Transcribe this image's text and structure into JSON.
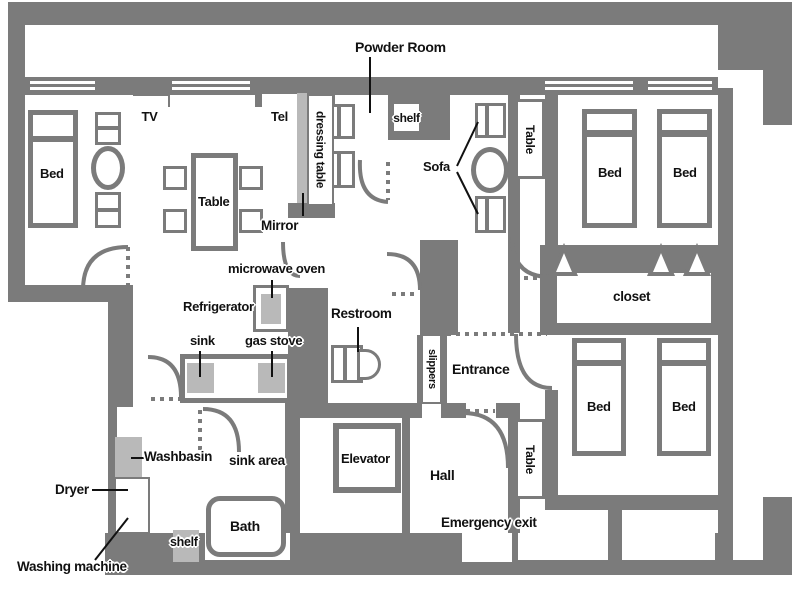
{
  "title": "Apartment floor plan",
  "colors": {
    "wall": "#7b7b7b",
    "fixture": "#b9b9b9",
    "text": "#111111",
    "background": "#ffffff"
  },
  "labels": {
    "powder_room": "Powder Room",
    "tv": "TV",
    "tel": "Tel",
    "dressing_table": "dressing table",
    "mirror": "Mirror",
    "shelf_top": "shelf",
    "sofa": "Sofa",
    "table_top_right": "Table",
    "bed_left": "Bed",
    "dining_table": "Table",
    "bed_top_1": "Bed",
    "bed_top_2": "Bed",
    "closet": "closet",
    "microwave_oven": "microwave oven",
    "refrigerator": "Refrigerator",
    "sink": "sink",
    "gas_stove": "gas stove",
    "restroom": "Restroom",
    "slippers": "slippers",
    "entrance": "Entrance",
    "bed_bottom_1": "Bed",
    "bed_bottom_2": "Bed",
    "table_bottom_right": "Table",
    "washbasin": "Washbasin",
    "dryer": "Dryer",
    "washing_machine": "Washing machine",
    "sink_area": "sink area",
    "shelf_bottom": "shelf",
    "bath": "Bath",
    "elevator": "Elevator",
    "hall": "Hall",
    "emergency_exit": "Emergency exit"
  }
}
